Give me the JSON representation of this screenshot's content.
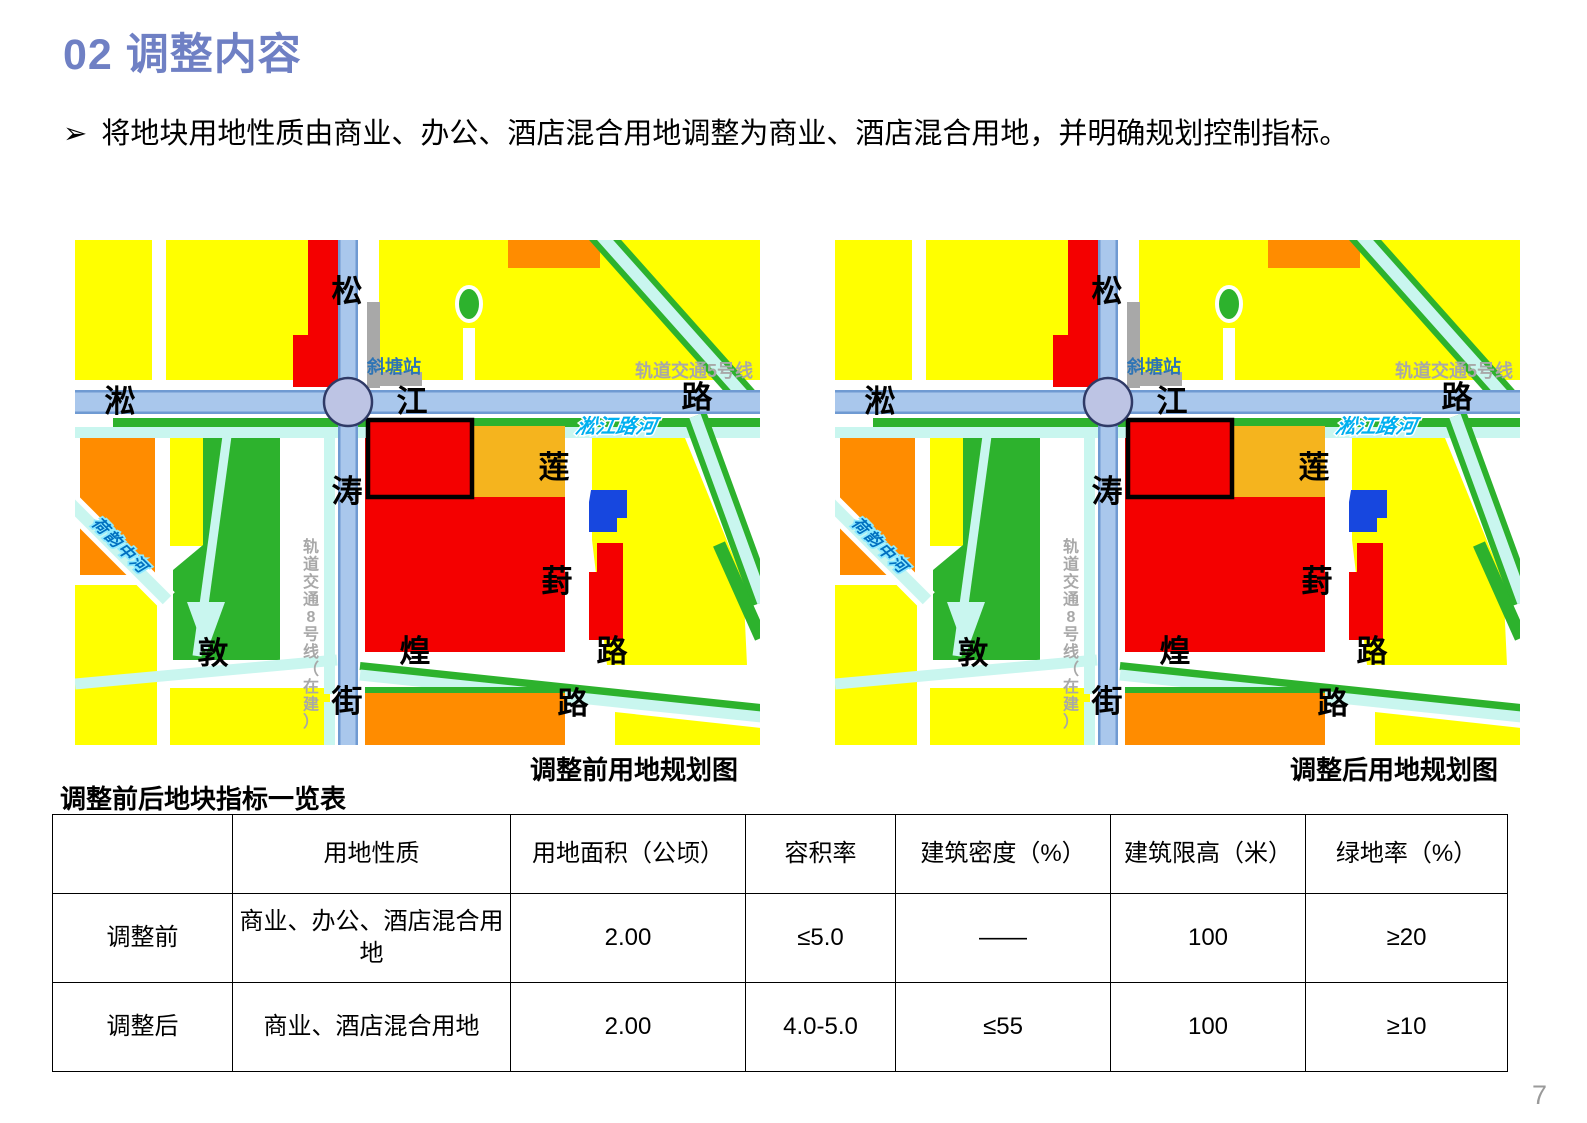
{
  "title": "02 调整内容",
  "bullet": {
    "marker": "➢",
    "text": "将地块用地性质由商业、办公、酒店混合用地调整为商业、酒店混合用地，并明确规划控制指标。"
  },
  "maps": {
    "before_caption": "调整前用地规划图",
    "after_caption": "调整后用地规划图",
    "labels": {
      "road_v_top": "松",
      "road_v_mid": "涛",
      "road_v_bottom": "街",
      "road_h_left": "淞",
      "road_h_mid": "江",
      "road_h_right": "路",
      "station": "斜塘站",
      "metro5": "轨道交通5号线",
      "river_main": "淞江路河",
      "river_sw": "荷韵中河",
      "road_s_left": "敦",
      "road_s_mid": "煌",
      "road_s_right": "路",
      "road_e_top": "莲",
      "road_e_mid": "葑",
      "road_e_bottom": "路",
      "metro8": "轨道交通8号线（在建）"
    },
    "palette": {
      "yellow": "#FFFF00",
      "green": "#2DB22D",
      "canal": "#C9F6EF",
      "orange": "#FF8C00",
      "amber": "#F5B41E",
      "red": "#F40000",
      "blue_block": "#1747DF",
      "road_fill": "#A9C7EC",
      "road_edge": "#6F9AD2",
      "station_fill": "#BDC4E4",
      "station_stroke": "#2F3A66",
      "gray": "#A8A8A8",
      "station_text": "#2E74B5",
      "river_text": "#00B0F0",
      "river_sw_text": "#0070C0",
      "river_sw_halo": "#8FEAFF",
      "plot_outline": "#000000"
    }
  },
  "table": {
    "title": "调整前后地块指标一览表",
    "headers": [
      "",
      "用地性质",
      "用地面积（公顷）",
      "容积率",
      "建筑密度（%）",
      "建筑限高（米）",
      "绿地率（%）"
    ],
    "rows": [
      {
        "label": "调整前",
        "cells": [
          "商业、办公、酒店混合用地",
          "2.00",
          "≤5.0",
          "——",
          "100",
          "≥20"
        ]
      },
      {
        "label": "调整后",
        "cells": [
          "商业、酒店混合用地",
          "2.00",
          "4.0-5.0",
          "≤55",
          "100",
          "≥10"
        ]
      }
    ]
  },
  "page": {
    "number": "7"
  }
}
